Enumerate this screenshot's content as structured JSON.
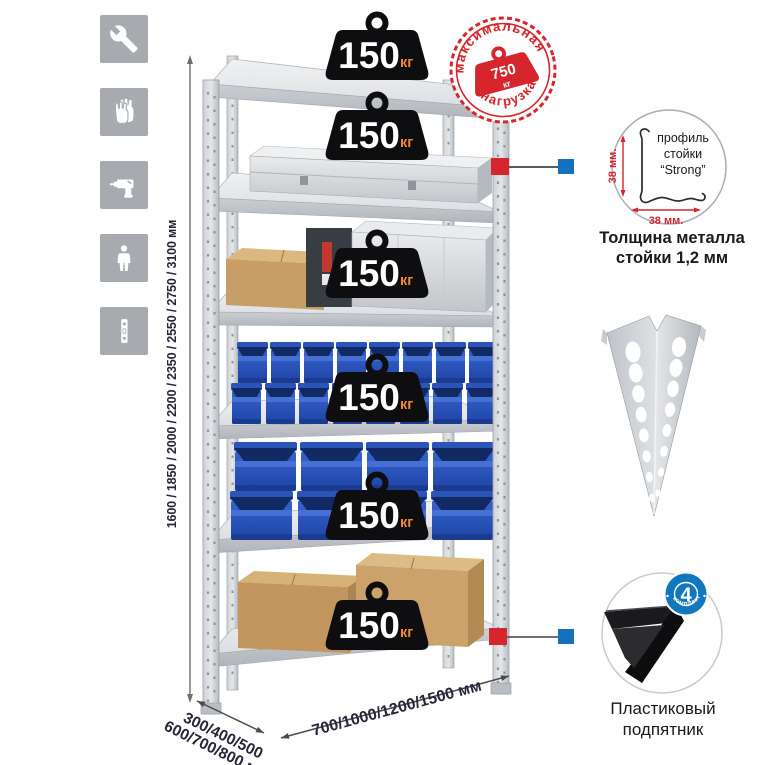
{
  "colors": {
    "accent_red": "#d6252c",
    "accent_blue": "#1371bd",
    "bin_blue": "#2a55bd",
    "metal_gray": "#c8ccd1",
    "weight_black": "#0e0e10",
    "kg_orange": "#ef8b2d"
  },
  "icons": [
    "wrench",
    "work-gloves",
    "drill",
    "person",
    "rack-post"
  ],
  "stamp": {
    "line_top": "максимальная",
    "line_bottom": "нагрузка",
    "weight_value": "750",
    "weight_unit": "кг"
  },
  "rack": {
    "shelves_count": 6,
    "shelf_load_value": "150",
    "shelf_load_unit": "кг"
  },
  "dimensions": {
    "height": "1600 / 1850 / 2000 / 2200 / 2350 / 2550 / 2750 / 3100 мм",
    "depth_line1": "300/400/500",
    "depth_line2": "600/700/800 мм",
    "width": "700/1000/1200/1500 мм"
  },
  "profile_detail": {
    "label_line1": "профиль",
    "label_line2": "стойки",
    "label_line3": "“Strong”",
    "dim_vertical": "38 мм.",
    "dim_horizontal": "38 мм.",
    "caption_line1": "Толщина металла",
    "caption_line2": "стойки 1,2 мм"
  },
  "foot_detail": {
    "badge_count": "4",
    "badge_text": "в комплекте",
    "caption_line1": "Пластиковый",
    "caption_line2": "подпятник"
  }
}
